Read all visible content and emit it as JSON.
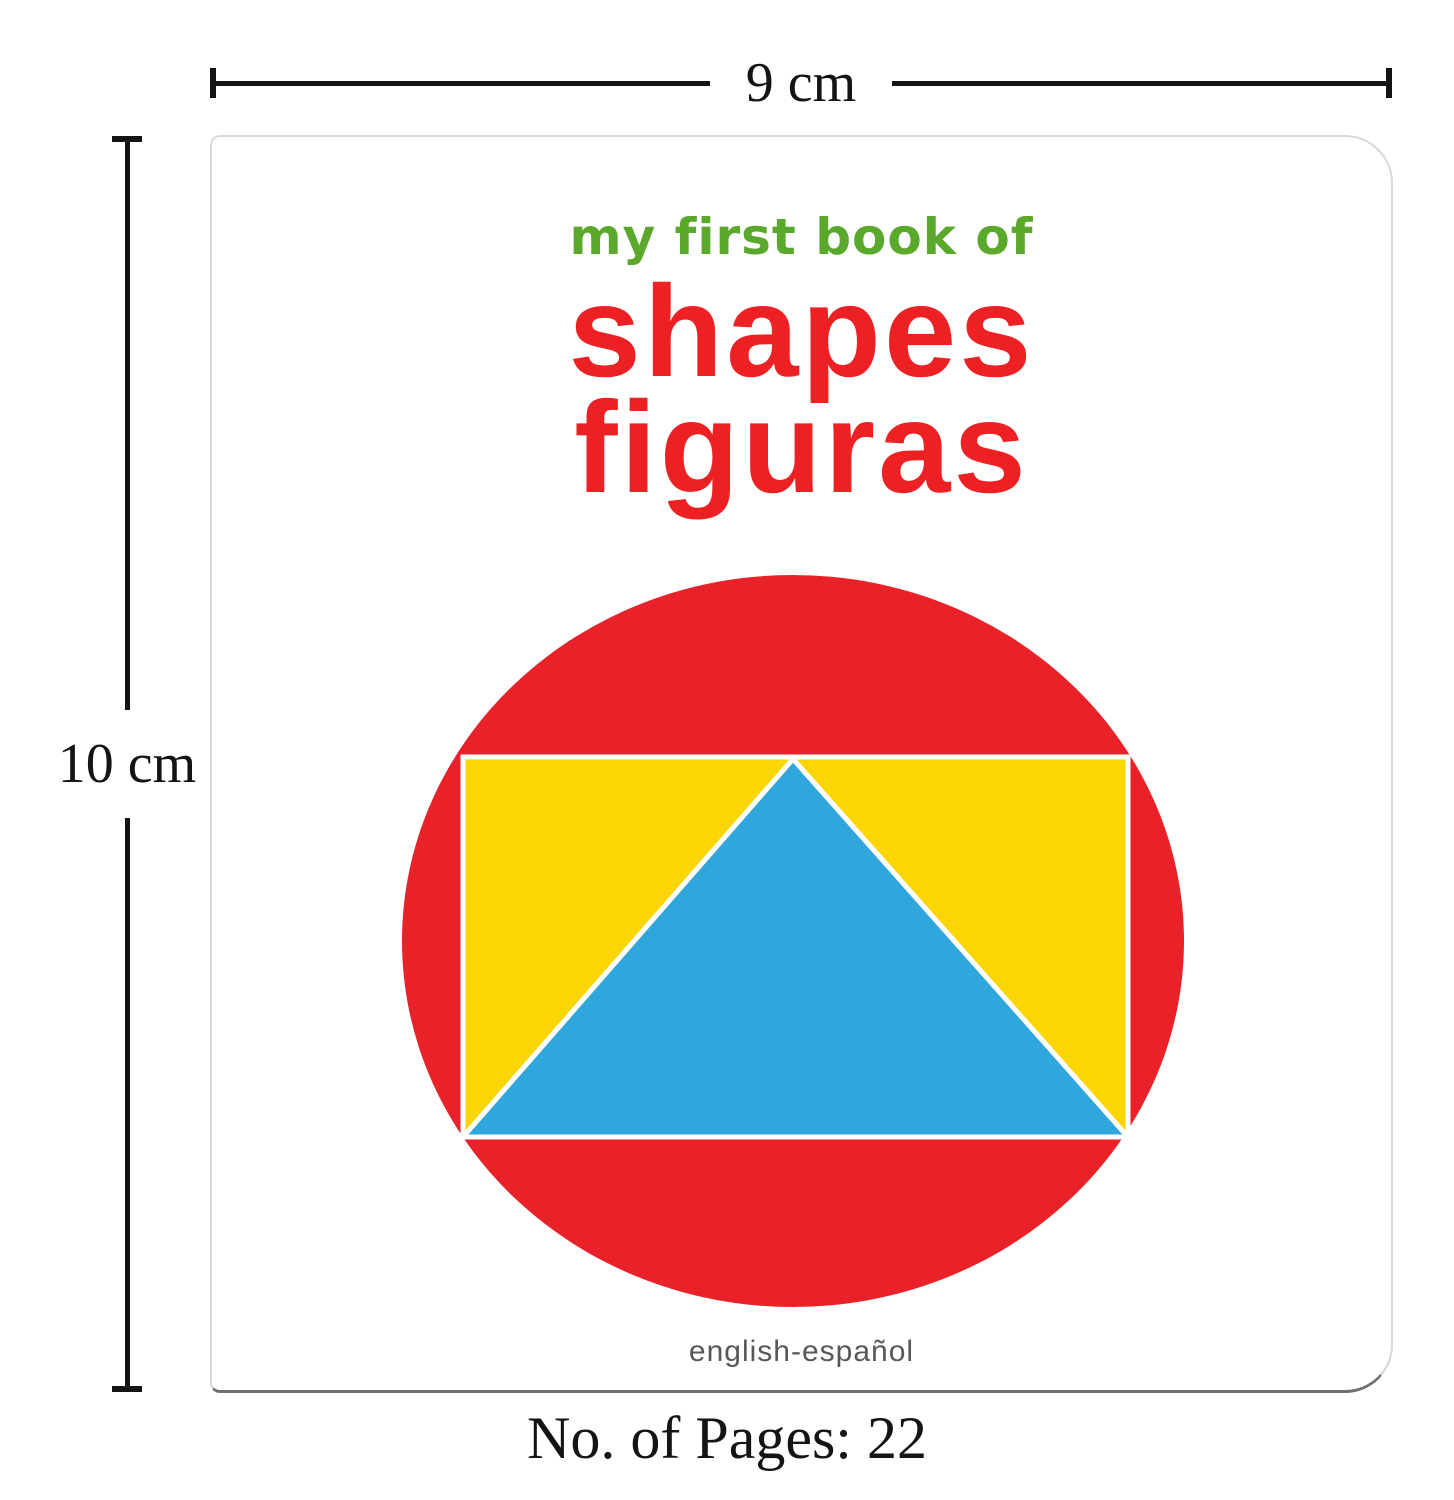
{
  "dimensions": {
    "width_label": "9 cm",
    "height_label": "10 cm"
  },
  "cover": {
    "series_title": "my first book of",
    "title_primary": "shapes",
    "title_secondary": "figuras",
    "language_note": "english-español",
    "colors": {
      "series_title_green": "#5aa82c",
      "title_red": "#ed2024"
    }
  },
  "graphic": {
    "shapes": [
      "circle",
      "rectangle",
      "triangle"
    ],
    "circle_color": "#e92128",
    "rectangle_color": "#fbd504",
    "triangle_color": "#30a7dc",
    "outline_color": "#ffffff"
  },
  "footer": {
    "pages_label": "No. of Pages: 22"
  }
}
